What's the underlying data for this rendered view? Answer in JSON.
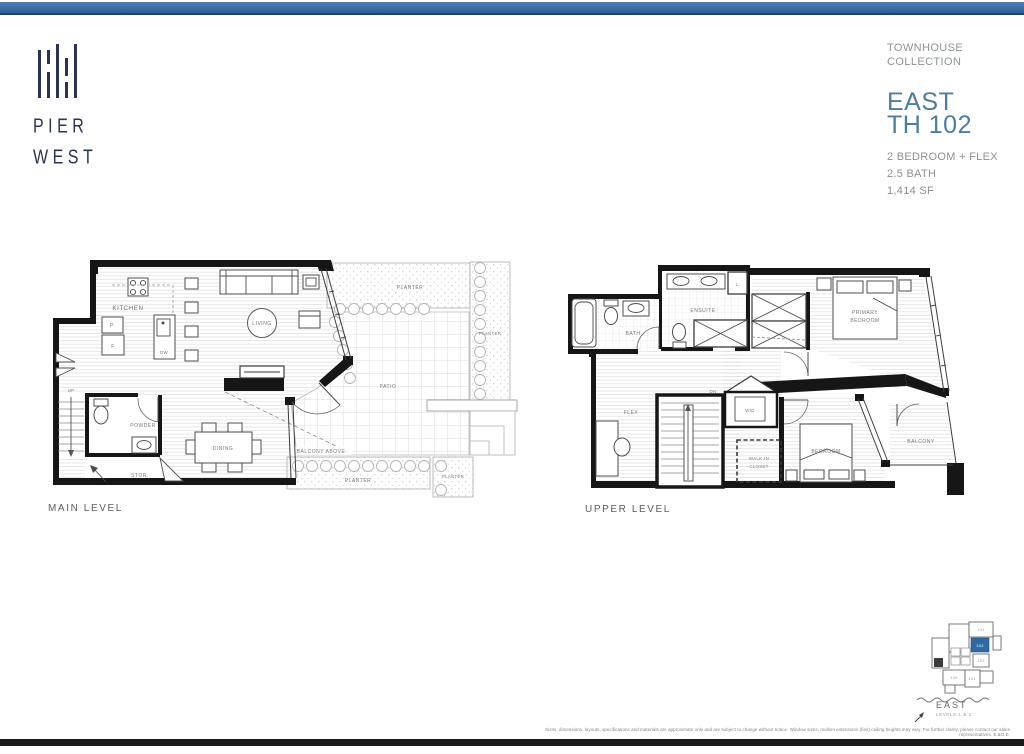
{
  "logo": {
    "line1": "PIER",
    "line2": "WEST"
  },
  "header": {
    "collection_line1": "TOWNHOUSE",
    "collection_line2": "COLLECTION",
    "plan_line1": "EAST",
    "plan_line2": "TH 102",
    "spec1": "2 BEDROOM + FLEX",
    "spec2": "2.5 BATH",
    "spec3": "1,414 SF",
    "accent_color": "#4d7d9d"
  },
  "plans": {
    "main": {
      "title": "MAIN LEVEL",
      "labels": {
        "kitchen": "KITCHEN",
        "pantry": "P",
        "fridge": "F",
        "dw": "DW",
        "living": "LIVING",
        "up": "UP",
        "powder": "POWDER",
        "stor": "STOR.",
        "dining": "DINING",
        "balcony_above": "BALCONY ABOVE",
        "patio": "PATIO",
        "planter": "PLANTER"
      }
    },
    "upper": {
      "title": "UPPER LEVEL",
      "labels": {
        "bath": "BATH",
        "ensuite": "ENSUITE",
        "linen": "L",
        "primary1": "PRIMARY",
        "primary2": "BEDROOM",
        "flex": "FLEX",
        "dn": "DN",
        "wd": "W/D",
        "wic1": "WALK-IN",
        "wic2": "CLOSET",
        "bedroom": "BEDROOM",
        "balcony": "BALCONY"
      }
    }
  },
  "keyplan": {
    "direction": "EAST",
    "levels": "LEVELS 1 & 2",
    "highlight_color": "#2e69a3",
    "units": {
      "u101": "101",
      "u102": "102",
      "u103": "103",
      "u104": "104",
      "u105": "105"
    }
  },
  "footer": {
    "disclaimer": "Sizes, dimensions, layouts, specifications and materials are approximate only and are subject to change without notice. Window sizes, mullion extensions (fins) ceiling heights may vary. For further clarity, please contact our sales representatives. E.&O.E."
  }
}
